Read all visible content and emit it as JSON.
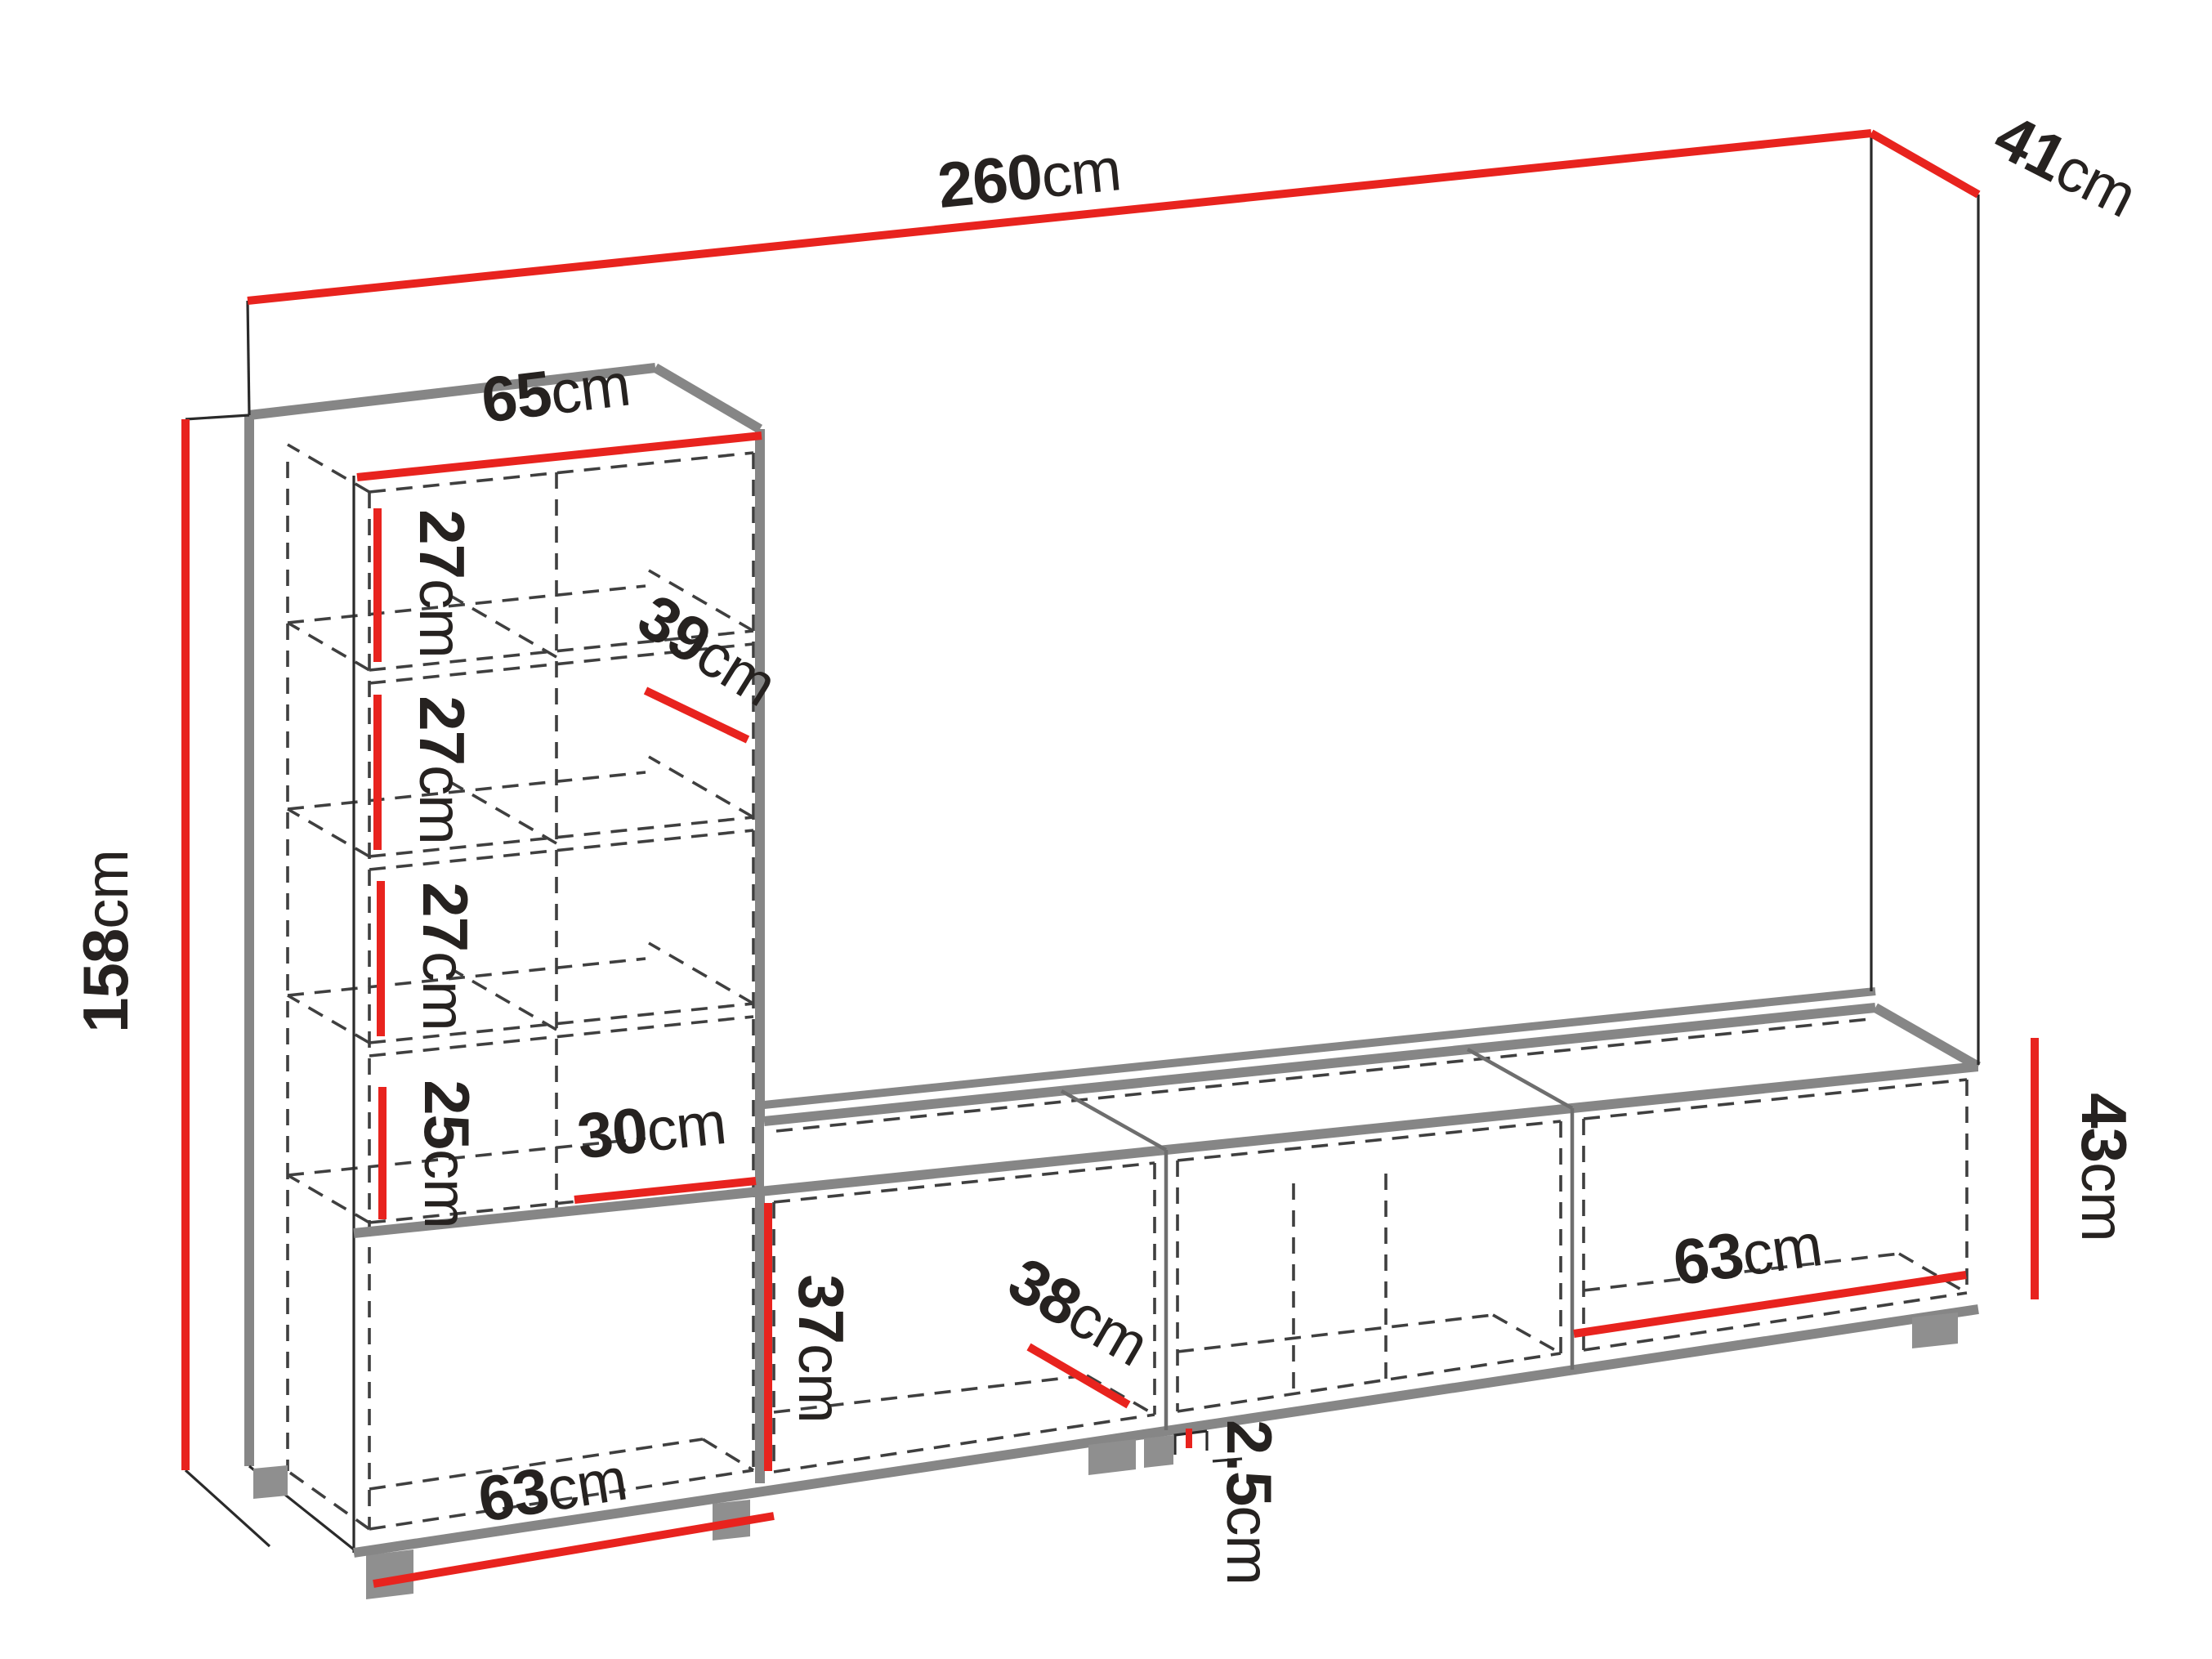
{
  "page": {
    "background": "#ffffff",
    "type": "furniture-dimension-diagram"
  },
  "palette": {
    "dimension_red": "#e8231e",
    "outline_gray": "#868686",
    "line_black": "#2a2a2a",
    "hidden_line_gray": "#3f3f3f",
    "label_black": "#262220",
    "feet_gray": "#8f8f8f"
  },
  "dimensions": {
    "total_width": {
      "value": "260",
      "unit": "cm"
    },
    "total_depth": {
      "value": "41",
      "unit": "cm"
    },
    "total_height": {
      "value": "158",
      "unit": "cm"
    },
    "tower_width": {
      "value": "65",
      "unit": "cm"
    },
    "cubby_row_1_height": {
      "value": "27",
      "unit": "cm"
    },
    "cubby_row_2_height": {
      "value": "27",
      "unit": "cm"
    },
    "cubby_row_3_height": {
      "value": "27",
      "unit": "cm"
    },
    "cubby_row_4_height": {
      "value": "25",
      "unit": "cm"
    },
    "shelf_depth": {
      "value": "39",
      "unit": "cm"
    },
    "right_column_width": {
      "value": "30",
      "unit": "cm"
    },
    "base_left_width": {
      "value": "63",
      "unit": "cm"
    },
    "tv_opening_height": {
      "value": "37",
      "unit": "cm"
    },
    "tv_inner_depth": {
      "value": "38",
      "unit": "cm"
    },
    "bottom_panel_thickness": {
      "value": "2.5",
      "unit": "cm"
    },
    "base_right_width": {
      "value": "63",
      "unit": "cm"
    },
    "tv_side_height": {
      "value": "43",
      "unit": "cm"
    }
  }
}
